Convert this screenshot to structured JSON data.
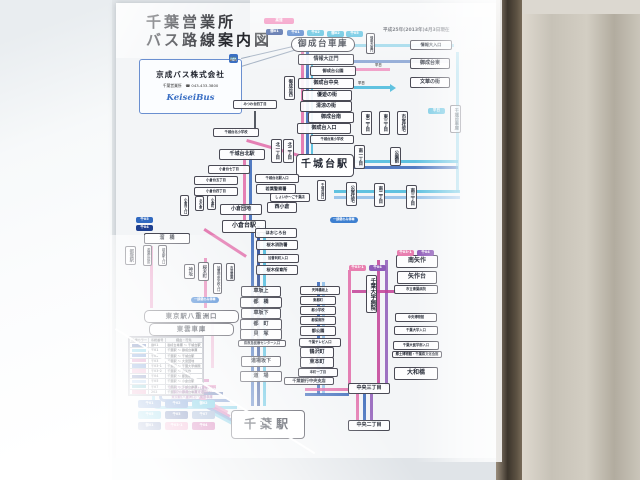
{
  "poster": {
    "title": "千葉営業所\nバス路線案内図",
    "date_note": "平成25年(2013年)4月3日現在",
    "company": {
      "name": "京成バス株式会社",
      "office_phone": "千葉営業所　☎ 043-433-3800",
      "logo": "KeiseiBus",
      "bus_icon_glyph": "🚌"
    },
    "terminals": {
      "onaridai_depot": "御成台車庫",
      "chishirodai_sta": "千城台駅",
      "chiba_sta": "千葉駅",
      "tokyo_sta": "東京駅八重洲口",
      "shinonome_depot": "東雲車庫"
    },
    "stations": {
      "onari_chain": [
        "情報大正門",
        "御成台公園",
        "御成台中央",
        "優遊の街",
        "清涼の街",
        "御成台南",
        "御成台入口",
        "千城台東小学校"
      ],
      "east_branch": [
        "情報大入口",
        "御成台東",
        "文華の街"
      ],
      "vert_onari": [
        "御成台西",
        "情報大東門",
        "千城台車庫",
        "千城台西口"
      ],
      "chishirodai_north": [
        "北一丁目",
        "北二丁目"
      ],
      "chishirodai_east": [
        "東二丁目",
        "東三丁目",
        "市営住宅",
        "南一丁目",
        "公園前"
      ],
      "chishirodai_south": [
        "公営住宅",
        "南二丁目",
        "南三丁目"
      ],
      "north_chain": [
        "みつわ台四丁目",
        "千城台北小学校",
        "千城台北駅",
        "小倉台七丁目",
        "小倉台五丁目",
        "小倉台四丁目",
        "小倉団地",
        "小倉台駅",
        "西小倉",
        "千城台北駅入口",
        "若葉警察署",
        "しょいか〜ご千葉店"
      ],
      "ogura_vert": [
        "小倉台入口",
        "北小倉",
        "小倉町"
      ],
      "tsuga_area": [
        "溜　橋",
        "都賀駅",
        "若葉区役所",
        "桜木駅入口",
        "神坂",
        "桜木町",
        "加曽利中学校入口",
        "市営霊園"
      ],
      "sakuragi_chain": [
        "ほおじろ台",
        "桜木消防署",
        "加曽利町入口",
        "桜木保育所"
      ],
      "center_column": [
        "車坂上",
        "都　橋",
        "車坂下",
        "都　町",
        "貝　塚",
        "県救急医療センター入口",
        "道場坂下",
        "道　場"
      ],
      "right_column": [
        "天神橋坂上",
        "東都町",
        "都小学校",
        "都保育所",
        "都公園",
        "千葉テレビ入口",
        "鶴沢町",
        "東本町",
        "本町一丁目",
        "千葉銀行中央支店"
      ],
      "yahagi_column": [
        "南矢作",
        "矢作台",
        "市立青葉病院",
        "千葉大学病院",
        "中央博物館",
        "千葉大学入口",
        "千葉大医学部入口",
        "郷土博物館・千葉県文化会館",
        "大和橋",
        "中央三丁目",
        "中央二丁目"
      ]
    },
    "chips_top": {
      "express": "高速",
      "row": [
        "御01",
        "千01",
        "千02",
        "御02",
        "千05"
      ]
    },
    "chips_misc": {
      "left": [
        "千05",
        "千04"
      ],
      "yahagi": [
        "千03-1",
        "千04"
      ],
      "hospital": [
        "千03-1",
        "千04"
      ],
      "weekday": "平日"
    },
    "notes": {
      "partial_stop": "一部便のみ停車",
      "weekday_left": "平日",
      "weekday_right": "平日"
    },
    "legend": {
      "headers": [
        "路線カラー",
        "系統番号",
        "経由・行先"
      ],
      "rows": [
        {
          "color": "#1e3f8f",
          "no": "御01",
          "desc": "御成台車庫 〜 千城台駅"
        },
        {
          "color": "#3ab4d8",
          "no": "千01",
          "desc": "千葉駅 〜 御成台車庫"
        },
        {
          "color": "#3069c0",
          "no": "千02",
          "desc": "千葉駅 〜 千城台駅"
        },
        {
          "color": "#c9549e",
          "no": "千03",
          "desc": "千葉駅 〜 大宮団地"
        },
        {
          "color": "#3069c0",
          "no": "千03-1",
          "desc": "千葉駅 〜 千葉大学病院"
        },
        {
          "color": "#e88ab8",
          "no": "千03-2",
          "desc": "千葉駅 〜 南矢作"
        },
        {
          "color": "#23408f",
          "no": "千04",
          "desc": "千葉駅 〜 都賀駅"
        },
        {
          "color": "#7fb2e5",
          "no": "千05",
          "desc": "千葉駅 〜 小倉台駅"
        },
        {
          "color": "#2a9fae",
          "no": "千07",
          "desc": "千葉駅 〜 千城台車庫"
        },
        {
          "color": "#e06c9f",
          "no": "202",
          "desc": "千葉駅 〜 御成台車庫"
        }
      ],
      "notes": [
        "マイタウンダイレクト(高速バス)",
        "御成台車庫 〜(高速道路)〜",
        "東京駅(八重洲口)・東雲車庫"
      ]
    },
    "chips_bottom": [
      {
        "label": "千01",
        "color": "#3069c0"
      },
      {
        "label": "千02",
        "color": "#3069c0"
      },
      {
        "label": "御02",
        "color": "#3ab4d8"
      },
      {
        "label": "千05",
        "color": "#3ab4d8"
      },
      {
        "label": "千03",
        "color": "#23408f"
      },
      {
        "label": "千07",
        "color": "#6f8fc0"
      },
      {
        "label": "御01",
        "color": "#1e3f8f"
      },
      {
        "label": "千03-1",
        "color": "#e87fb0"
      },
      {
        "label": "千04",
        "color": "#c23f96"
      }
    ],
    "colors": {
      "pink": "#e06aa8",
      "magenta": "#c23f96",
      "blue": "#3565b8",
      "navy": "#1e3f8f",
      "cyan": "#45b8dc",
      "lightblue": "#8bbce8",
      "purple": "#8e5bb8"
    }
  }
}
